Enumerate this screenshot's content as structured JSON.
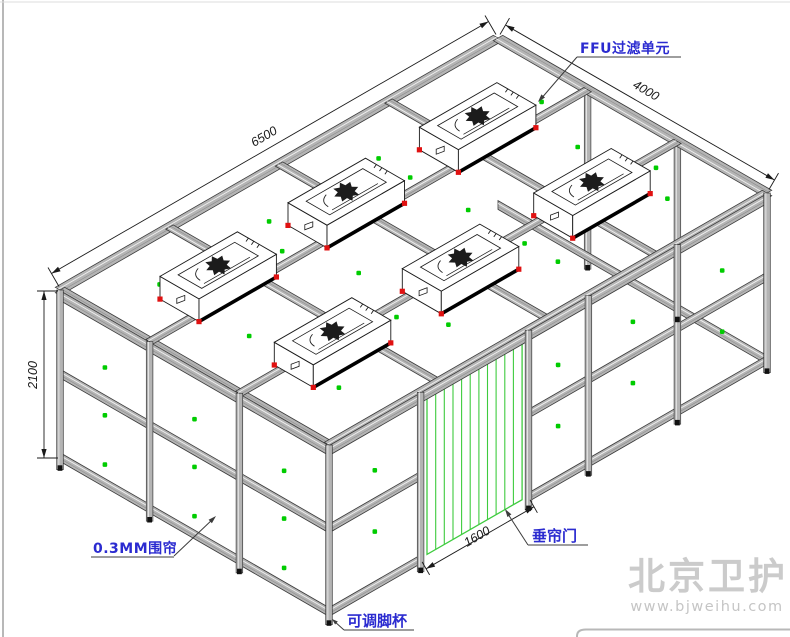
{
  "dimensions": {
    "length": "6500",
    "width": "4000",
    "height": "2100",
    "door_width": "1600"
  },
  "labels": {
    "ffu": "FFU过滤单元",
    "curtain": "0.3MM围帘",
    "door": "垂帘门",
    "foot": "可调脚杯"
  },
  "watermark": {
    "name": "北京卫护",
    "url": "www.bjweihu.com"
  },
  "colors": {
    "label_blue": "#2b2bd0",
    "dim_black": "#1a1a1a",
    "leader_dark": "#3c3c3c",
    "dot_green": "#00cc00",
    "door_green": "#3ecb3e",
    "ffu_red": "#e01111",
    "beam_fill": "#b4b4b4",
    "beam_edge": "#3a3a3a",
    "beam_hi": "#f0f0f0",
    "beam_lo": "#8d8d8d",
    "watermark_gray": "#cbcbcb",
    "watermark_url_gray": "#c5c5c5"
  }
}
